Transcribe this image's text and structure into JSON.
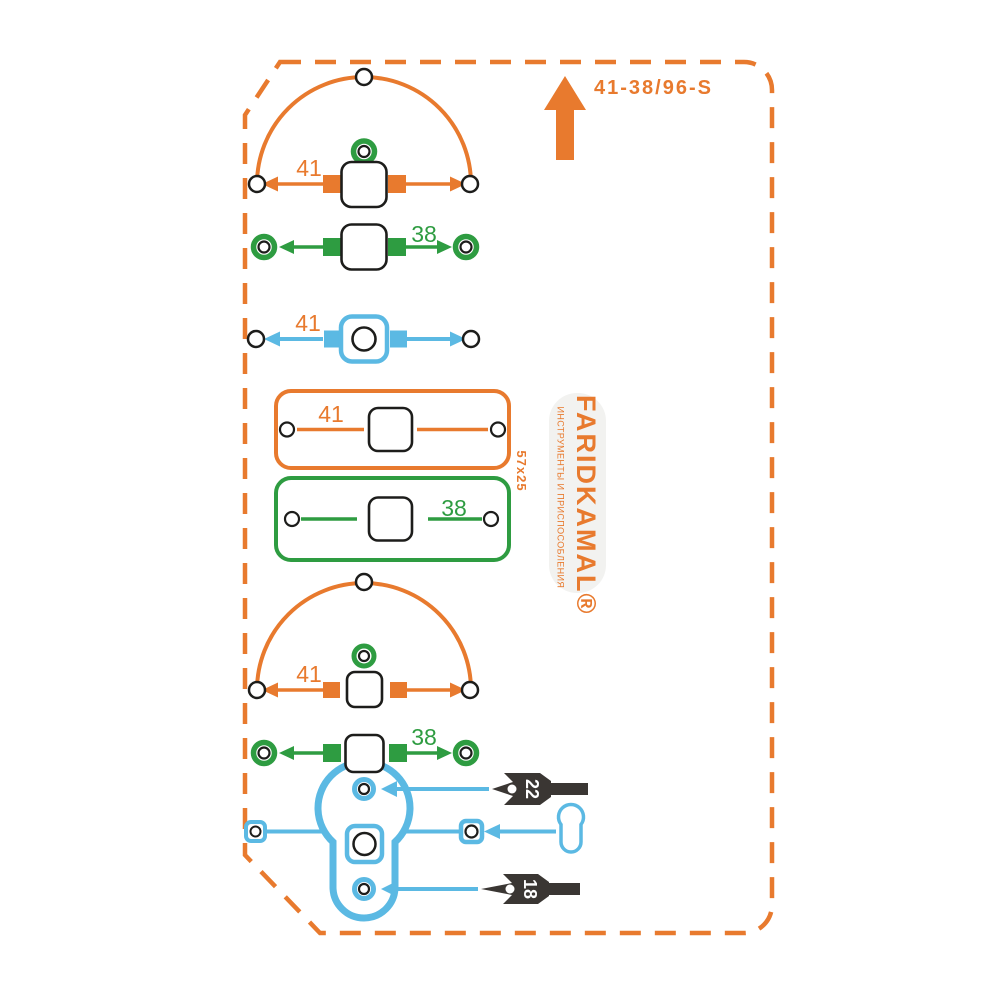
{
  "product": {
    "model": "41-38/96-S"
  },
  "brand": {
    "name": "FARIDKAMAL®",
    "tagline": "ИНСТРУМЕНТЫ И ПРИСПОСОБЛЕНИЯ"
  },
  "plate": {
    "size": "57x25"
  },
  "dims": {
    "arc_top": "41",
    "green_top": "38",
    "blue_row": "41",
    "plate_orange": "41",
    "plate_green": "38",
    "arc_bottom": "41",
    "green_bottom": "38"
  },
  "drill_diameters": {
    "top": "22",
    "bottom": "18"
  },
  "colors": {
    "orange": "#E87A2E",
    "green": "#2E9C41",
    "blue": "#5BB9E3",
    "dark": "#3A3633"
  }
}
